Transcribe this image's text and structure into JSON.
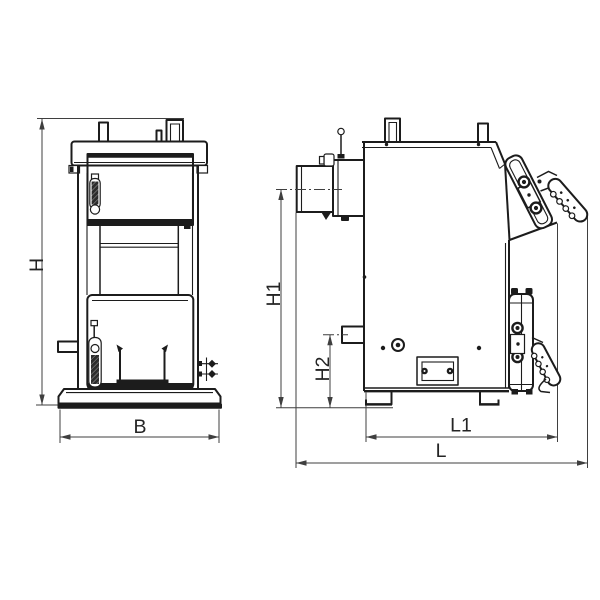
{
  "drawing": {
    "type": "technical line drawing",
    "subject": "solid fuel boiler dimensional drawing, two orthographic views",
    "views": [
      "front elevation",
      "side elevation"
    ]
  },
  "dims": {
    "front": {
      "height": "H",
      "width": "B"
    },
    "side": {
      "flue_height": "H1",
      "return_height": "H2",
      "inner_length": "L1",
      "overall_length": "L"
    }
  },
  "colors": {
    "line": "#1c1c1c",
    "dim": "#3f3f3f",
    "text": "#242424",
    "dark": "#1c1c1c",
    "fill": "#ffffff",
    "background": "#ffffff"
  }
}
